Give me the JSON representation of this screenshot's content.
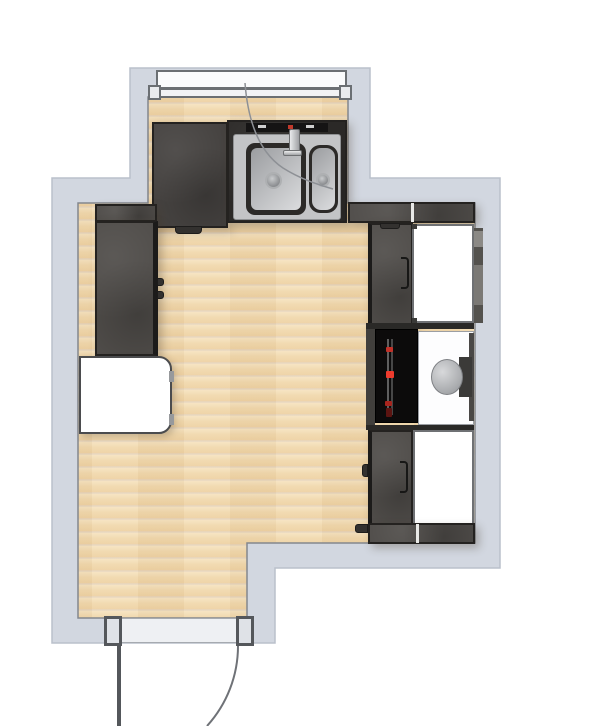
{
  "scene": {
    "title": "Kitchen floor plan"
  },
  "palette": {
    "outside": "#ffffff",
    "wall": "#d2d7e0",
    "wall_outer_line": "#bac0cb",
    "wall_inner_line": "#83878e",
    "floor": "#f2dab4",
    "cabinet": "#4f4c49",
    "cabinet_dark": "#242220",
    "counter": "#454240",
    "sink_box": "#2b2927",
    "steel": "#c3c4c6",
    "steel_dark": "#8f9193",
    "white_item": "#ffffff",
    "item_border": "#6f7174",
    "oven": "#0c0b0b",
    "led_red": "#ee3b2d",
    "led_dim": "#b2291f",
    "window_fill": "#fafbfc",
    "frame": "#6b6f73",
    "door_fill": "#eef0f3",
    "door_line": "#54575b",
    "arc": "#6f7277",
    "boiler": "#a9abae"
  },
  "elements": {
    "room": {
      "label": "Kitchen room"
    },
    "floor": {
      "label": "Wood floor"
    },
    "walls": {
      "label": "Walls"
    },
    "window": {
      "label": "Window"
    },
    "counter_left": {
      "label": "Worktop section"
    },
    "sink": {
      "label": "Double-bowl sink"
    },
    "faucet": {
      "label": "Faucet"
    },
    "tall_cabinet": {
      "label": "Tall cabinet"
    },
    "left_appliance": {
      "label": "White appliance"
    },
    "upper_cabinet": {
      "label": "Base cabinet"
    },
    "upper_appliance": {
      "label": "Built-in appliance"
    },
    "oven": {
      "label": "Oven"
    },
    "boiler": {
      "label": "Boiler"
    },
    "lower_cabinet": {
      "label": "Base cabinet"
    },
    "lower_appliance": {
      "label": "Built-in appliance"
    },
    "plinth": {
      "label": "Cabinet plinth"
    },
    "door": {
      "label": "Door"
    }
  }
}
